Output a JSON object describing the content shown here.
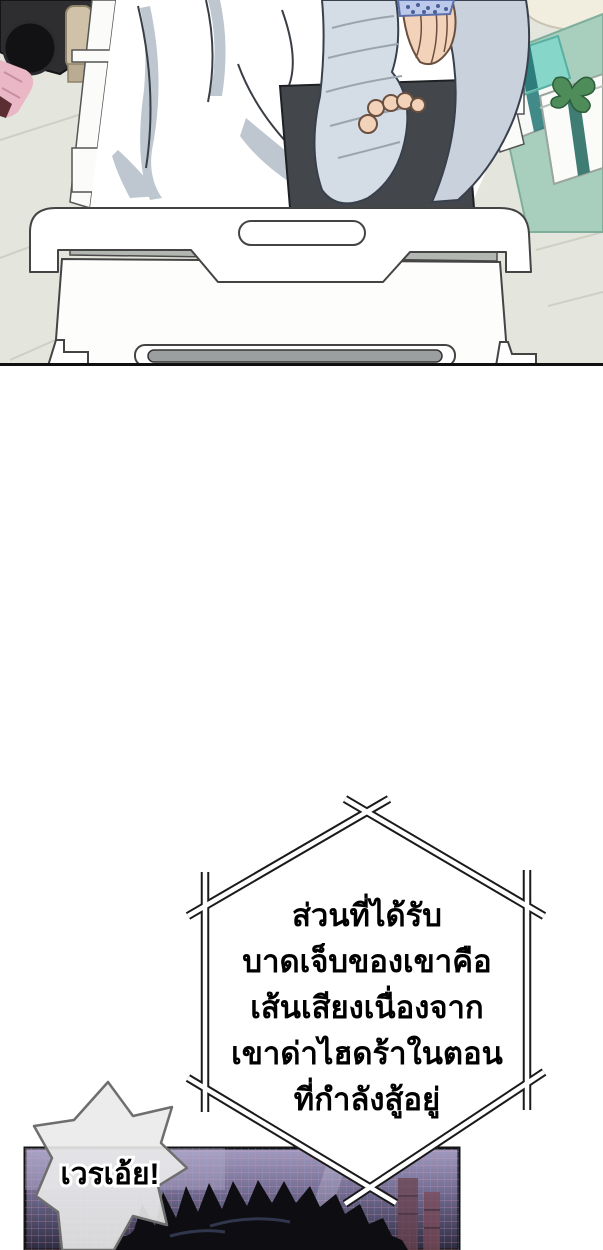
{
  "narration_box": {
    "lines": [
      "ส่วนที่ได้รับ",
      "บาดเจ็บของเขาคือ",
      "เส้นเสียงเนื่องจาก",
      "เขาด่าไฮดร้าในตอน",
      "ที่กำลังสู้อยู่"
    ]
  },
  "speech_bubble": {
    "text": "เวรเอ้ย!"
  },
  "colors": {
    "floor": "#e4e5dc",
    "tile_line": "#c9cabf",
    "table_top": "#a8cfbd",
    "gift_lid_teal": "#86d7c9",
    "ribbon_dark_teal": "#2e7d7d",
    "bow_green": "#4e8c5a",
    "camera_body": "#2e2d2f",
    "hand_skin": "#f2d3ba",
    "pink_item": "#e9b7c6",
    "tan_item": "#cfc2a8",
    "blanket_shadow": "#b7c0ca",
    "cast_bandage": "#d4dce5",
    "arm_rest_pad": "#43474b",
    "cuff_blue": "#bcc9ea",
    "bed_frame_line": "#444444",
    "slot_gray": "#9b9fa0",
    "panel_top": "#a39cc0",
    "panel_bottom": "#2e2a3e",
    "hair_black": "#0d0d12",
    "bubble_fill": "#eaeaea",
    "bubble_stroke": "#6e6e6e",
    "text_black": "#000000"
  }
}
